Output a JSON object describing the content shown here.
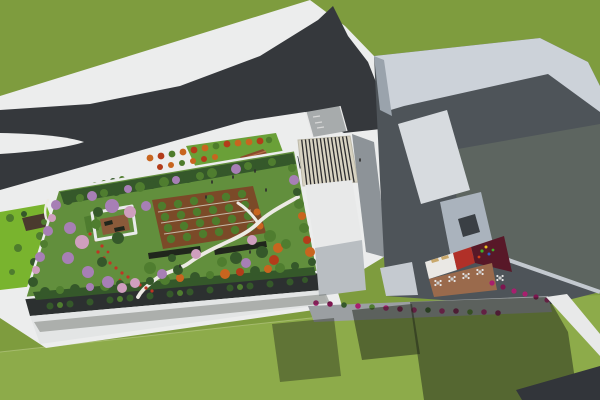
{
  "scene": {
    "type": "architectural-3d-rendering",
    "view": "aerial-perspective",
    "elements": {
      "grass_field": "large green lawn surrounding site",
      "forked_road": "dark asphalt road forking toward left edge",
      "entrance_plaza": "white plaza with orange trees, amphitheater steps and kiosk",
      "rooftop_garden": "garden roof with lawn, orchard grid, pavilion, winding path, flower bed, perimeter trees",
      "striped_canopy": "slatted pergola canopy at the entrance",
      "main_building": "large angular gray building with white facade panel and dark slab wall",
      "courtyard": "inner terrace with white/red/maroon/brown floors, tables, benches and playground",
      "bushes": "magenta shrub rows along building bases",
      "shadows": "long building shadows cast on walkways and grass"
    }
  },
  "colors": {
    "grass_base": "#7e9c3e",
    "grass_bottom": "#8dab4a",
    "grass_strip": "#79b42e",
    "road": "#35383c",
    "road_shadow": "#32353a",
    "white_surface": "#eceded",
    "white_dim": "#e3e5e5",
    "ramp_gray": "#a7abac",
    "walkway_gray": "#9b9fa2",
    "walkway_mid": "#8d9398",
    "canopy_cream": "#d8d3c2",
    "canopy_stripe": "#2c2c2e",
    "garden_lawn": "#628f3d",
    "garden_band_dark": "#35582a",
    "facade_dark": "#2c3030",
    "orchard_brown": "#7b4a28",
    "planter_dark": "#20261c",
    "path_white": "#eceae4",
    "pavilion_brown": "#8a5a3a",
    "pavilion_roof_green": "#4e7c2f",
    "pergola_dark": "#4a3a2e",
    "plaza_lawn": "#6aa038",
    "amphitheater_brown": "#8a4a2c",
    "amphitheater_step": "#b5714a",
    "kiosk_dark": "#23282b",
    "bldg_silhouette": "#4e5459",
    "bldg_band": "#ccd2d9",
    "bldg_slab": "#5d6560",
    "bldg_panel_white": "#d7dbdf",
    "bldg_face_light": "#9aa3ac",
    "bldg_sloped": "#aab3bd",
    "bldg_sloped2": "#c5cad0",
    "skylight": "#3a3f44",
    "parapet_light": "#c3c9cf",
    "court_white": "#eae8e4",
    "court_red": "#b13028",
    "court_maroon": "#581828",
    "court_brown": "#9a6a4c",
    "bench_tan": "#c9a86b",
    "lowroof_white": "#e8e9e9",
    "lowface_gray": "#b9bec2",
    "tree_green": "#5e8c3b",
    "tree_green_mid": "#4f7d2f",
    "tree_green_dark": "#35582a",
    "tree_purple": "#a77fb5",
    "tree_pink": "#cf9fbe",
    "tree_orange": "#c8651f",
    "tree_red_orange": "#b33c1a",
    "tree_row": "#4e7c2c",
    "flower_red": "#c03524",
    "bush_magenta": "#a81f6e",
    "bush_magenta_dark": "#7d1650",
    "shadow": "#1d2318",
    "seam": "#cdd6a0",
    "people_dark": "#2e2e2e",
    "table_center": "#c9c9c9",
    "table_white": "#e6e6e6",
    "play_green": "#3fae2a",
    "play_yellow": "#e8c020",
    "play_blue": "#2b60c5",
    "play_red": "#d04018"
  }
}
